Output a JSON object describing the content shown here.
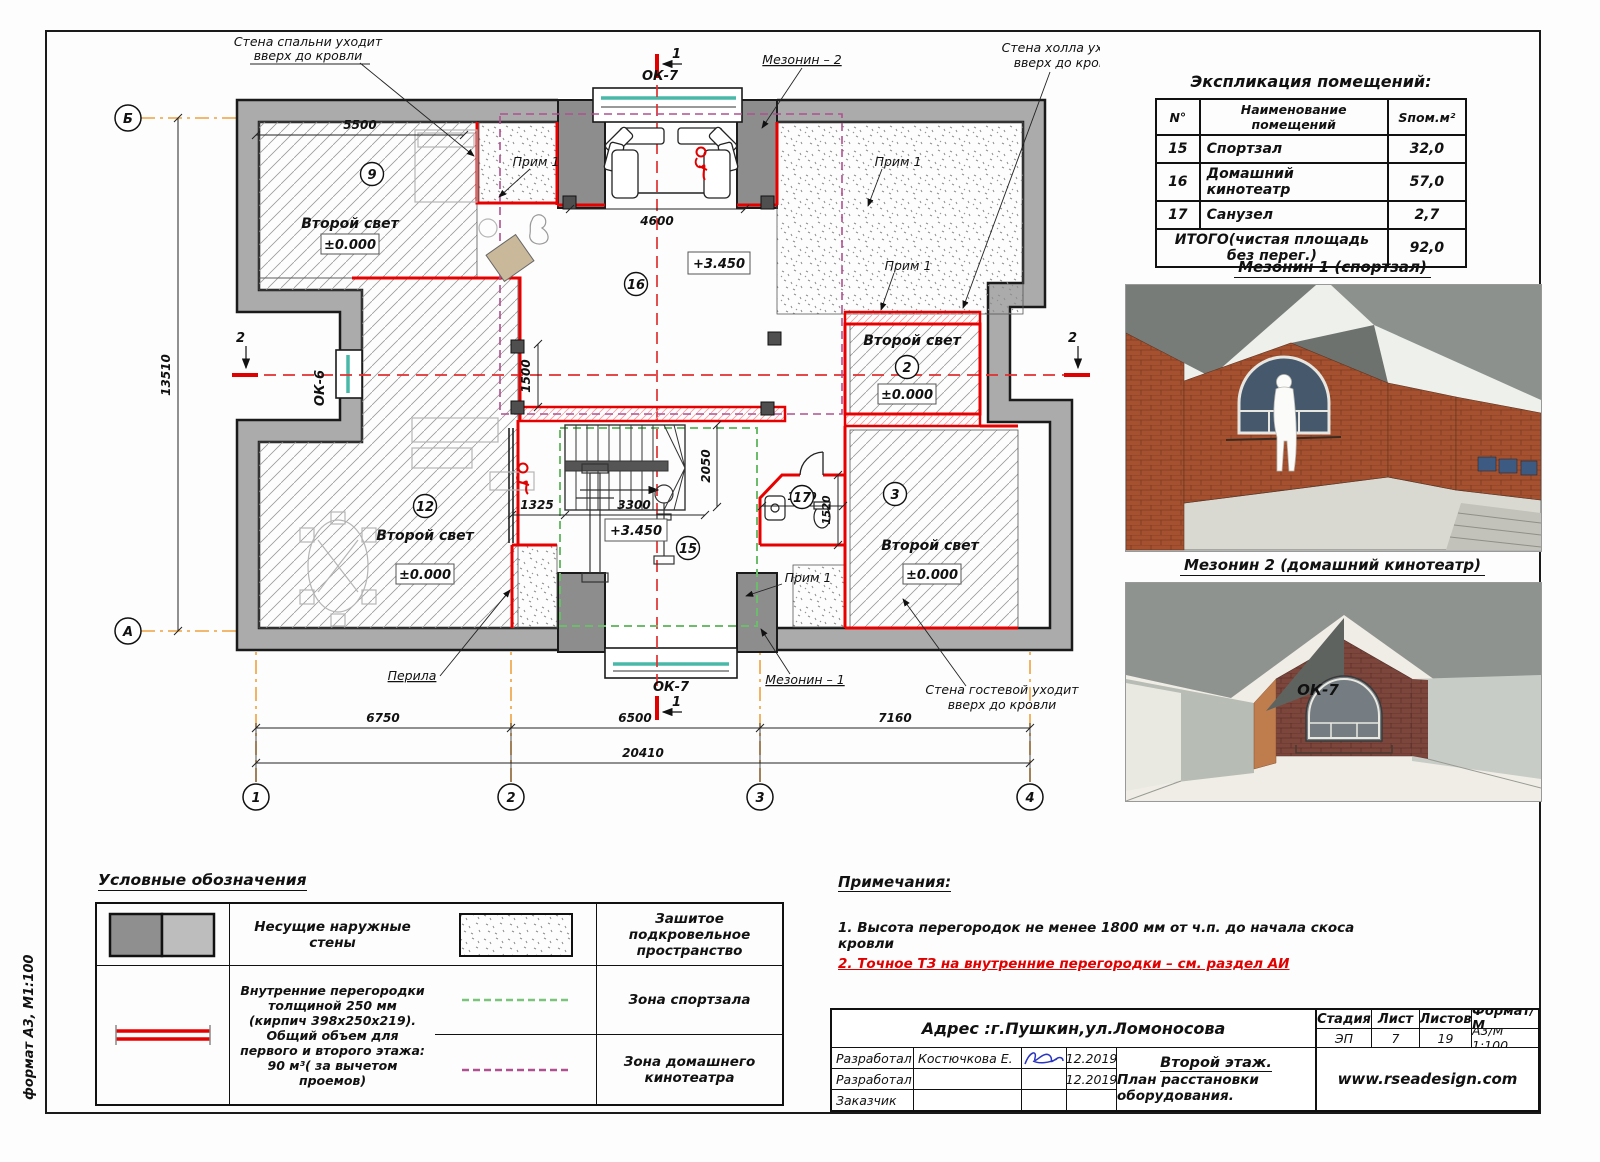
{
  "sheet": {
    "side_label": "формат А3, М1:100"
  },
  "colors": {
    "partition_red": "#e80000",
    "zone_gym_green": "#6cbc6c",
    "zone_theater_purple": "#b05090",
    "grid_orange": "#eea23e",
    "glass_teal": "#49b8a8",
    "note_red": "#e00000",
    "signature_blue": "#2a35c0"
  },
  "plan": {
    "callouts": {
      "bedroom1": "Стена спальни уходит",
      "bedroom2": "вверх до кровли",
      "hall1": "Стена холла уходит",
      "hall2": "вверх до кровли",
      "guest1": "Стена гостевой уходит",
      "guest2": "вверх до кровли",
      "mez1": "Мезонин – 1",
      "mez2": "Мезонин – 2",
      "perila": "Перила",
      "prim": "Прим 1"
    },
    "windows": {
      "ok7": "ОК-7",
      "ok6": "ОК-6"
    },
    "sections": {
      "s1": "1",
      "s2": "2"
    },
    "grid": {
      "b": "Б",
      "a": "А",
      "c1": "1",
      "c2": "2",
      "c3": "3",
      "c4": "4"
    },
    "rooms": {
      "r9": "9",
      "r12": "12",
      "r16": "16",
      "r15": "15",
      "r17": "17",
      "r2": "2",
      "r3": "3"
    },
    "labels": {
      "second_light": "Второй свет"
    },
    "levels": {
      "zero": "±0.000",
      "up": "+3.450"
    },
    "dims": {
      "d5500": "5500",
      "d4600": "4600",
      "d13510": "13510",
      "d1500": "1500",
      "d1325": "1325",
      "d3300": "3300",
      "d2050": "2050",
      "d1900": "1900",
      "d1520": "1520",
      "d6750": "6750",
      "d6500": "6500",
      "d7160": "7160",
      "d20410": "20410"
    }
  },
  "explication": {
    "title": "Экспликация помещений:",
    "headers": [
      "N°",
      "Наименование помещений",
      "Sпом.м²"
    ],
    "rows": [
      [
        "15",
        "Спортзал",
        "32,0"
      ],
      [
        "16",
        "Домашний кинотеатр",
        "57,0"
      ],
      [
        "17",
        "Санузел",
        "2,7"
      ]
    ],
    "total_label": "ИТОГО(чистая площадь без перег.)",
    "total_value": "92,0"
  },
  "renders": {
    "r1_title": "Мезонин 1 (спортзал)",
    "r2_title": "Мезонин 2 (домашний кинотеатр)",
    "r2_window": "ОК-7"
  },
  "legend": {
    "title": "Условные обозначения",
    "walls": "Несущие  наружные стены",
    "partitions": "Внутренние перегородки толщиной 250 мм (кирпич 398х250х219). Общий объем для первого и второго этажа: 90 м³( за вычетом проемов)",
    "roofspace": "Зашитое подкровельное пространство",
    "gym_zone": "Зона спортзала",
    "cinema_zone": "Зона домашнего кинотеатра"
  },
  "notes": {
    "title": "Примечания:",
    "n1": "1. Высота перегородок не менее 1800 мм от ч.п. до начала скоса кровли",
    "n2": "2. Точное ТЗ на внутренние перегородки – см. раздел АИ"
  },
  "titleblock": {
    "address": "Адрес :г.Пушкин,ул.Ломоносова",
    "rows": [
      {
        "role": "Разработал",
        "name": "Костючкова Е.",
        "date": "12.2019"
      },
      {
        "role": "Разработал",
        "name": "",
        "date": "12.2019"
      },
      {
        "role": "Заказчик",
        "name": "",
        "date": ""
      }
    ],
    "doc_line1": "Второй этаж.",
    "doc_line2": "План расстановки оборудования.",
    "stage_label": "Стадия",
    "sheet_label": "Лист",
    "sheets_label": "Листов",
    "format_label": "Формат/М",
    "stage": "ЭП",
    "sheet_num": "7",
    "sheets_total": "19",
    "format": "А3/М 1:100",
    "site": "www.rseadesign.com"
  }
}
